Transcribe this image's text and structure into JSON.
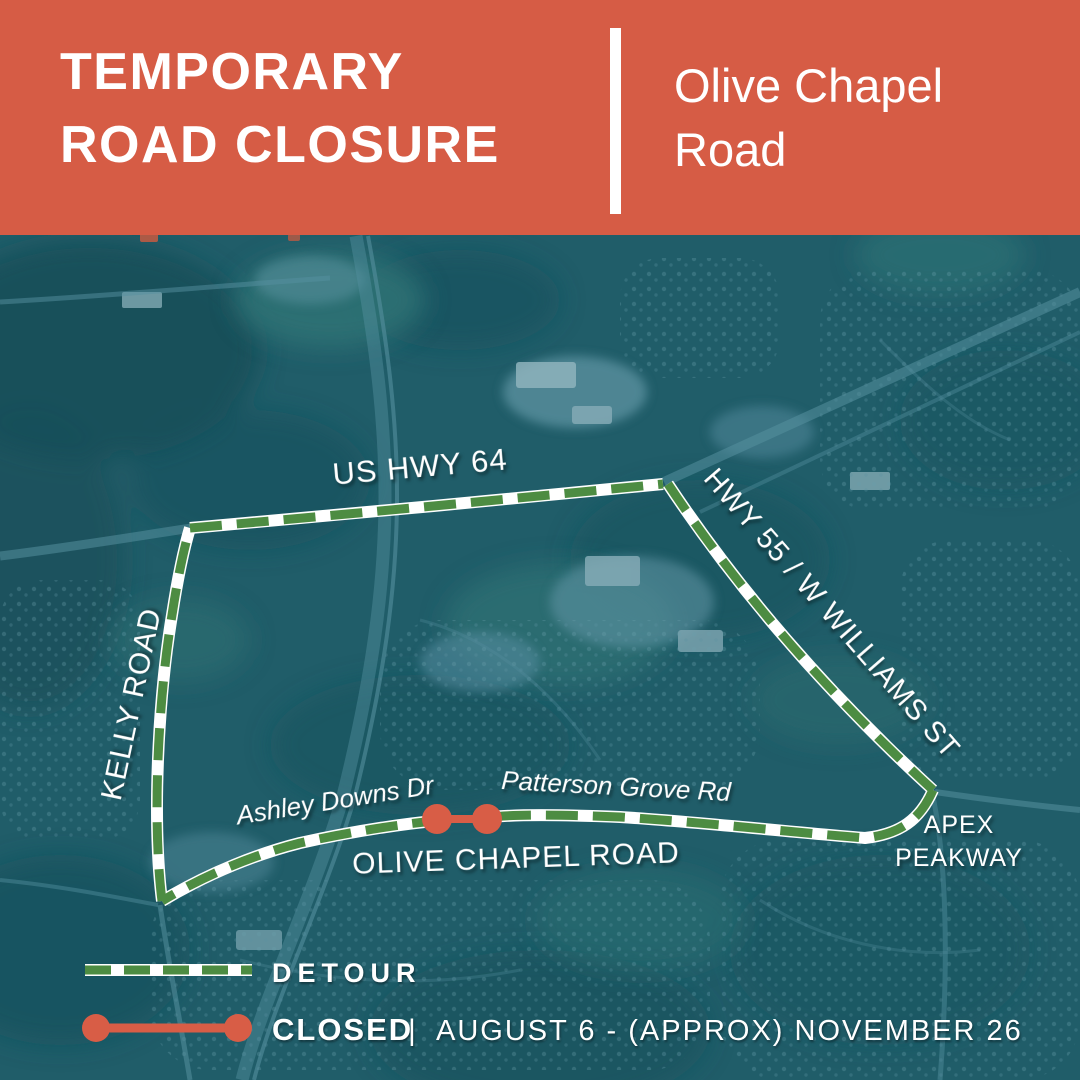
{
  "header": {
    "title_line1": "TEMPORARY",
    "title_line2": "ROAD CLOSURE",
    "subtitle_line1": "Olive Chapel",
    "subtitle_line2": "Road"
  },
  "map": {
    "labels": {
      "us_hwy_64": "US HWY 64",
      "hwy_55": "HWY 55 / W WILLIAMS ST",
      "kelly_road": "KELLY ROAD",
      "ashley_downs": "Ashley Downs Dr",
      "patterson_grove": "Patterson Grove Rd",
      "olive_chapel": "OLIVE CHAPEL ROAD",
      "apex_line1": "APEX",
      "apex_line2": "PEAKWAY"
    },
    "colors": {
      "header_orange": "#d65c45",
      "detour_green": "#4d8c42",
      "closed_red": "#d85d46",
      "route_white": "#ffffff",
      "map_base_teal": "#205d69"
    }
  },
  "legend": {
    "detour_label": "DETOUR",
    "closed_label": "CLOSED",
    "divider": "|",
    "closed_dates": "AUGUST 6 - (APPROX) NOVEMBER 26"
  }
}
